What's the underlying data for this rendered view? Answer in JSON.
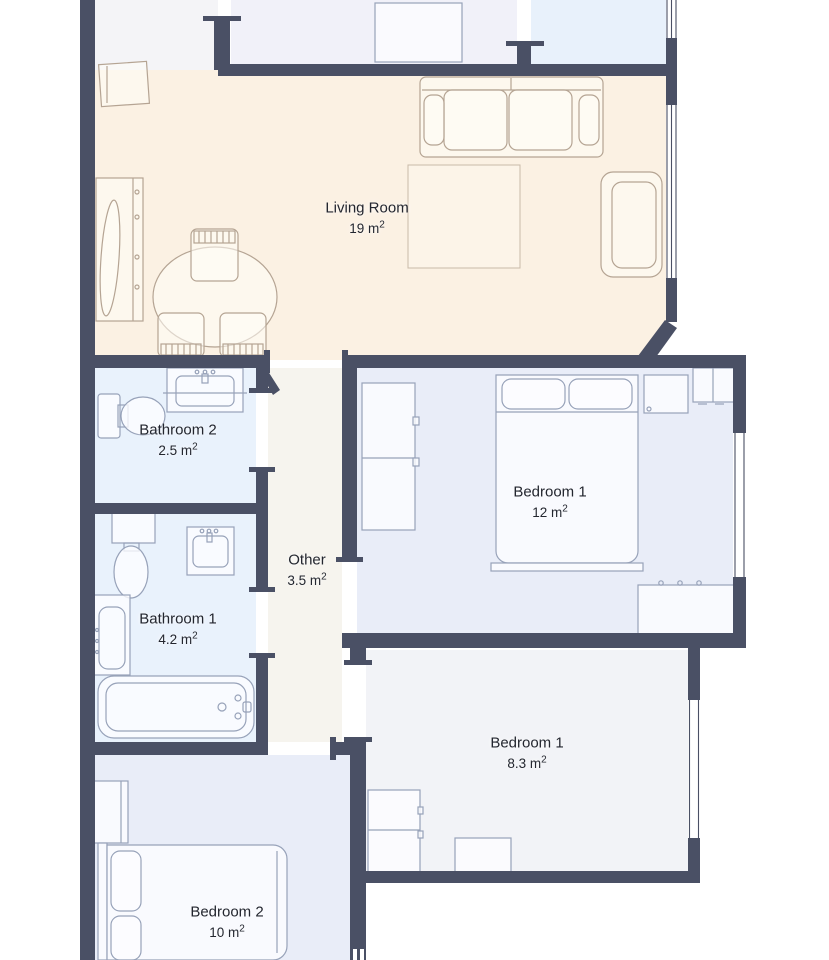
{
  "floorplan": {
    "rooms": [
      {
        "name": "Living Room",
        "area": "19 m",
        "area_sup": "2"
      },
      {
        "name": "Bathroom 2",
        "area": "2.5 m",
        "area_sup": "2"
      },
      {
        "name": "Other",
        "area": "3.5 m",
        "area_sup": "2"
      },
      {
        "name": "Bathroom 1",
        "area": "4.2 m",
        "area_sup": "2"
      },
      {
        "name": "Bedroom 1",
        "area": "12 m",
        "area_sup": "2"
      },
      {
        "name": "Bedroom 1",
        "area": "8.3 m",
        "area_sup": "2"
      },
      {
        "name": "Bedroom 2",
        "area": "10 m",
        "area_sup": "2"
      }
    ],
    "colors": {
      "wall": "#4a5065",
      "living_room_floor": "#fbf1e3",
      "bathroom_floor": "#e9f2fc",
      "bedroom_floor": "#e9edf8",
      "small_bedroom_floor": "#f2f3f7",
      "hallway_floor": "#f6f4ee",
      "upper_left_floor": "#f4f4f7",
      "upper_mid_floor": "#f1f1f9",
      "upper_right_floor": "#e8f1fb",
      "living_room_furniture_stroke": "#b5a493",
      "fixture_stroke": "#97a2b9",
      "label_text": "#23262f",
      "background": "#ffffff"
    }
  }
}
